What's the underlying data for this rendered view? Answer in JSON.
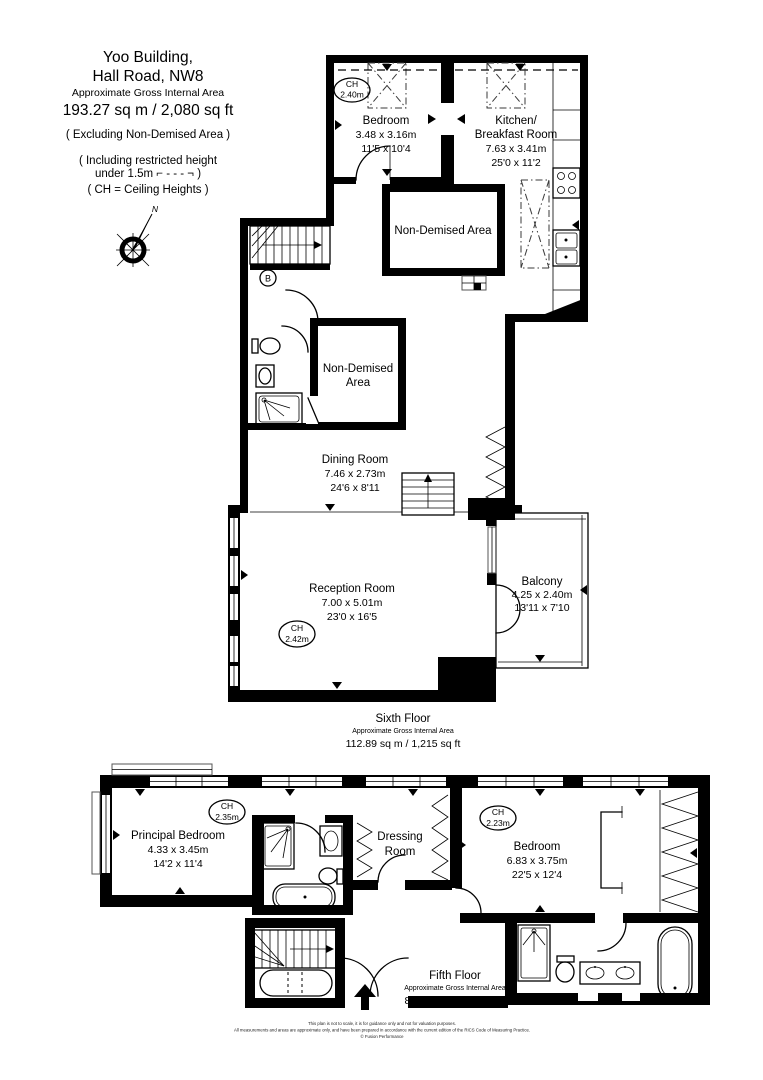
{
  "header": {
    "building_line1": "Yoo Building,",
    "building_line2": "Hall Road, NW8",
    "area_label": "Approximate Gross Internal Area",
    "area_value": "193.27 sq m  /  2,080 sq ft",
    "excluding_note": "( Excluding Non-Demised Area )",
    "restricted_note_line1": "( Including restricted height",
    "restricted_note_line2": "under 1.5m  ⌐ - - - ¬ )",
    "ch_note": "( CH = Ceiling Heights )",
    "compass_label": "N"
  },
  "sixth": {
    "bedroom": {
      "name": "Bedroom",
      "dims_m": "3.48 x 3.16m",
      "dims_ft": "11'5 x 10'4",
      "ch_label": "CH",
      "ch_value": "2.40m"
    },
    "kitchen": {
      "name_line1": "Kitchen/",
      "name_line2": "Breakfast Room",
      "dims_m": "7.63 x 3.41m",
      "dims_ft": "25'0 x 11'2"
    },
    "non_demised_large": {
      "name": "Non-Demised Area"
    },
    "non_demised_small": {
      "name_line1": "Non-Demised",
      "name_line2": "Area"
    },
    "riser": {
      "label": "B"
    },
    "dining": {
      "name": "Dining Room",
      "dims_m": "7.46 x 2.73m",
      "dims_ft": "24'6 x 8'11"
    },
    "reception": {
      "name": "Reception Room",
      "dims_m": "7.00 x 5.01m",
      "dims_ft": "23'0 x 16'5",
      "ch_label": "CH",
      "ch_value": "2.42m"
    },
    "balcony": {
      "name": "Balcony",
      "dims_m": "4.25 x 2.40m",
      "dims_ft": "13'11 x 7'10"
    },
    "floor_title": "Sixth Floor",
    "floor_area_label": "Approximate Gross Internal Area",
    "floor_area_value": "112.89 sq m  /  1,215 sq ft"
  },
  "fifth": {
    "principal_bedroom": {
      "name": "Principal Bedroom",
      "dims_m": "4.33 x 3.45m",
      "dims_ft": "14'2 x 11'4",
      "ch_label": "CH",
      "ch_value": "2.35m"
    },
    "dressing": {
      "name_line1": "Dressing",
      "name_line2": "Room"
    },
    "bedroom": {
      "name": "Bedroom",
      "dims_m": "6.83 x 3.75m",
      "dims_ft": "22'5 x 12'4",
      "ch_label": "CH",
      "ch_value": "2.23m"
    },
    "floor_title": "Fifth Floor",
    "floor_area_label": "Approximate Gross Internal Area",
    "floor_area_value": "80.37 sq m  /  865 sq ft"
  },
  "footer": {
    "line1": "This plan is not to scale, it is for guidance only and not for valuation purposes.",
    "line2": "All measurements and areas are approximate only, and have been prepared in accordance with the current edition of the RICS Code of Measuring Practice.",
    "line3": "© Fusion Performance"
  }
}
